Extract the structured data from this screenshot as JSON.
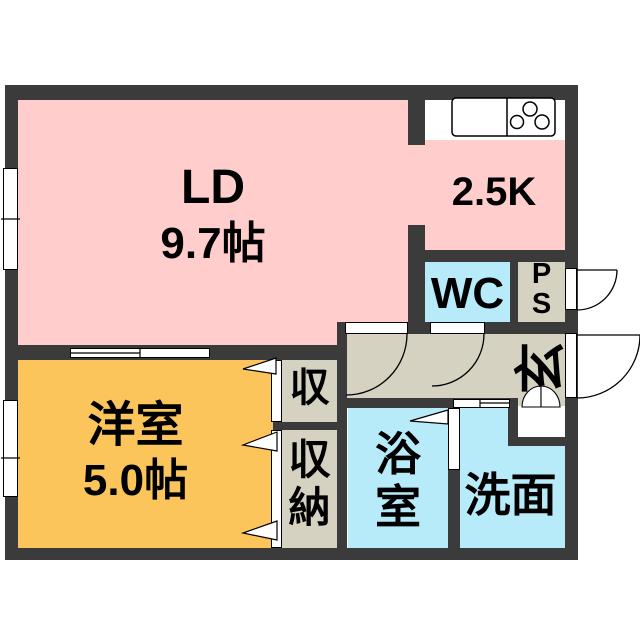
{
  "floor_plan": {
    "ld": {
      "name": "LD",
      "size": "9.7帖"
    },
    "kitchen": {
      "size_label": "2.5K"
    },
    "wc": {
      "label": "WC"
    },
    "ps": {
      "line1": "P",
      "line2": "S"
    },
    "genkan": {
      "label": "玄"
    },
    "western_room": {
      "name": "洋室",
      "size": "5.0帖"
    },
    "closet_upper": {
      "label": "収"
    },
    "closet_lower": {
      "label": "収\n納"
    },
    "bath": {
      "label": "浴\n室"
    },
    "washroom": {
      "label": "洗面"
    },
    "colors": {
      "wall": "#3b3b3b",
      "room_pink": "#fecdcc",
      "room_yellow": "#fcc55b",
      "room_cyan": "#b7ebfa",
      "room_beige": "#d5d2c2"
    },
    "icons": {
      "stove": "stove-burners-icon",
      "sink": "kitchen-sink-icon",
      "shoe_cabinet": "shoe-cabinet-icon",
      "door_swings": "door-swing-arc-icon",
      "folding_doors": "folding-door-icon"
    }
  }
}
